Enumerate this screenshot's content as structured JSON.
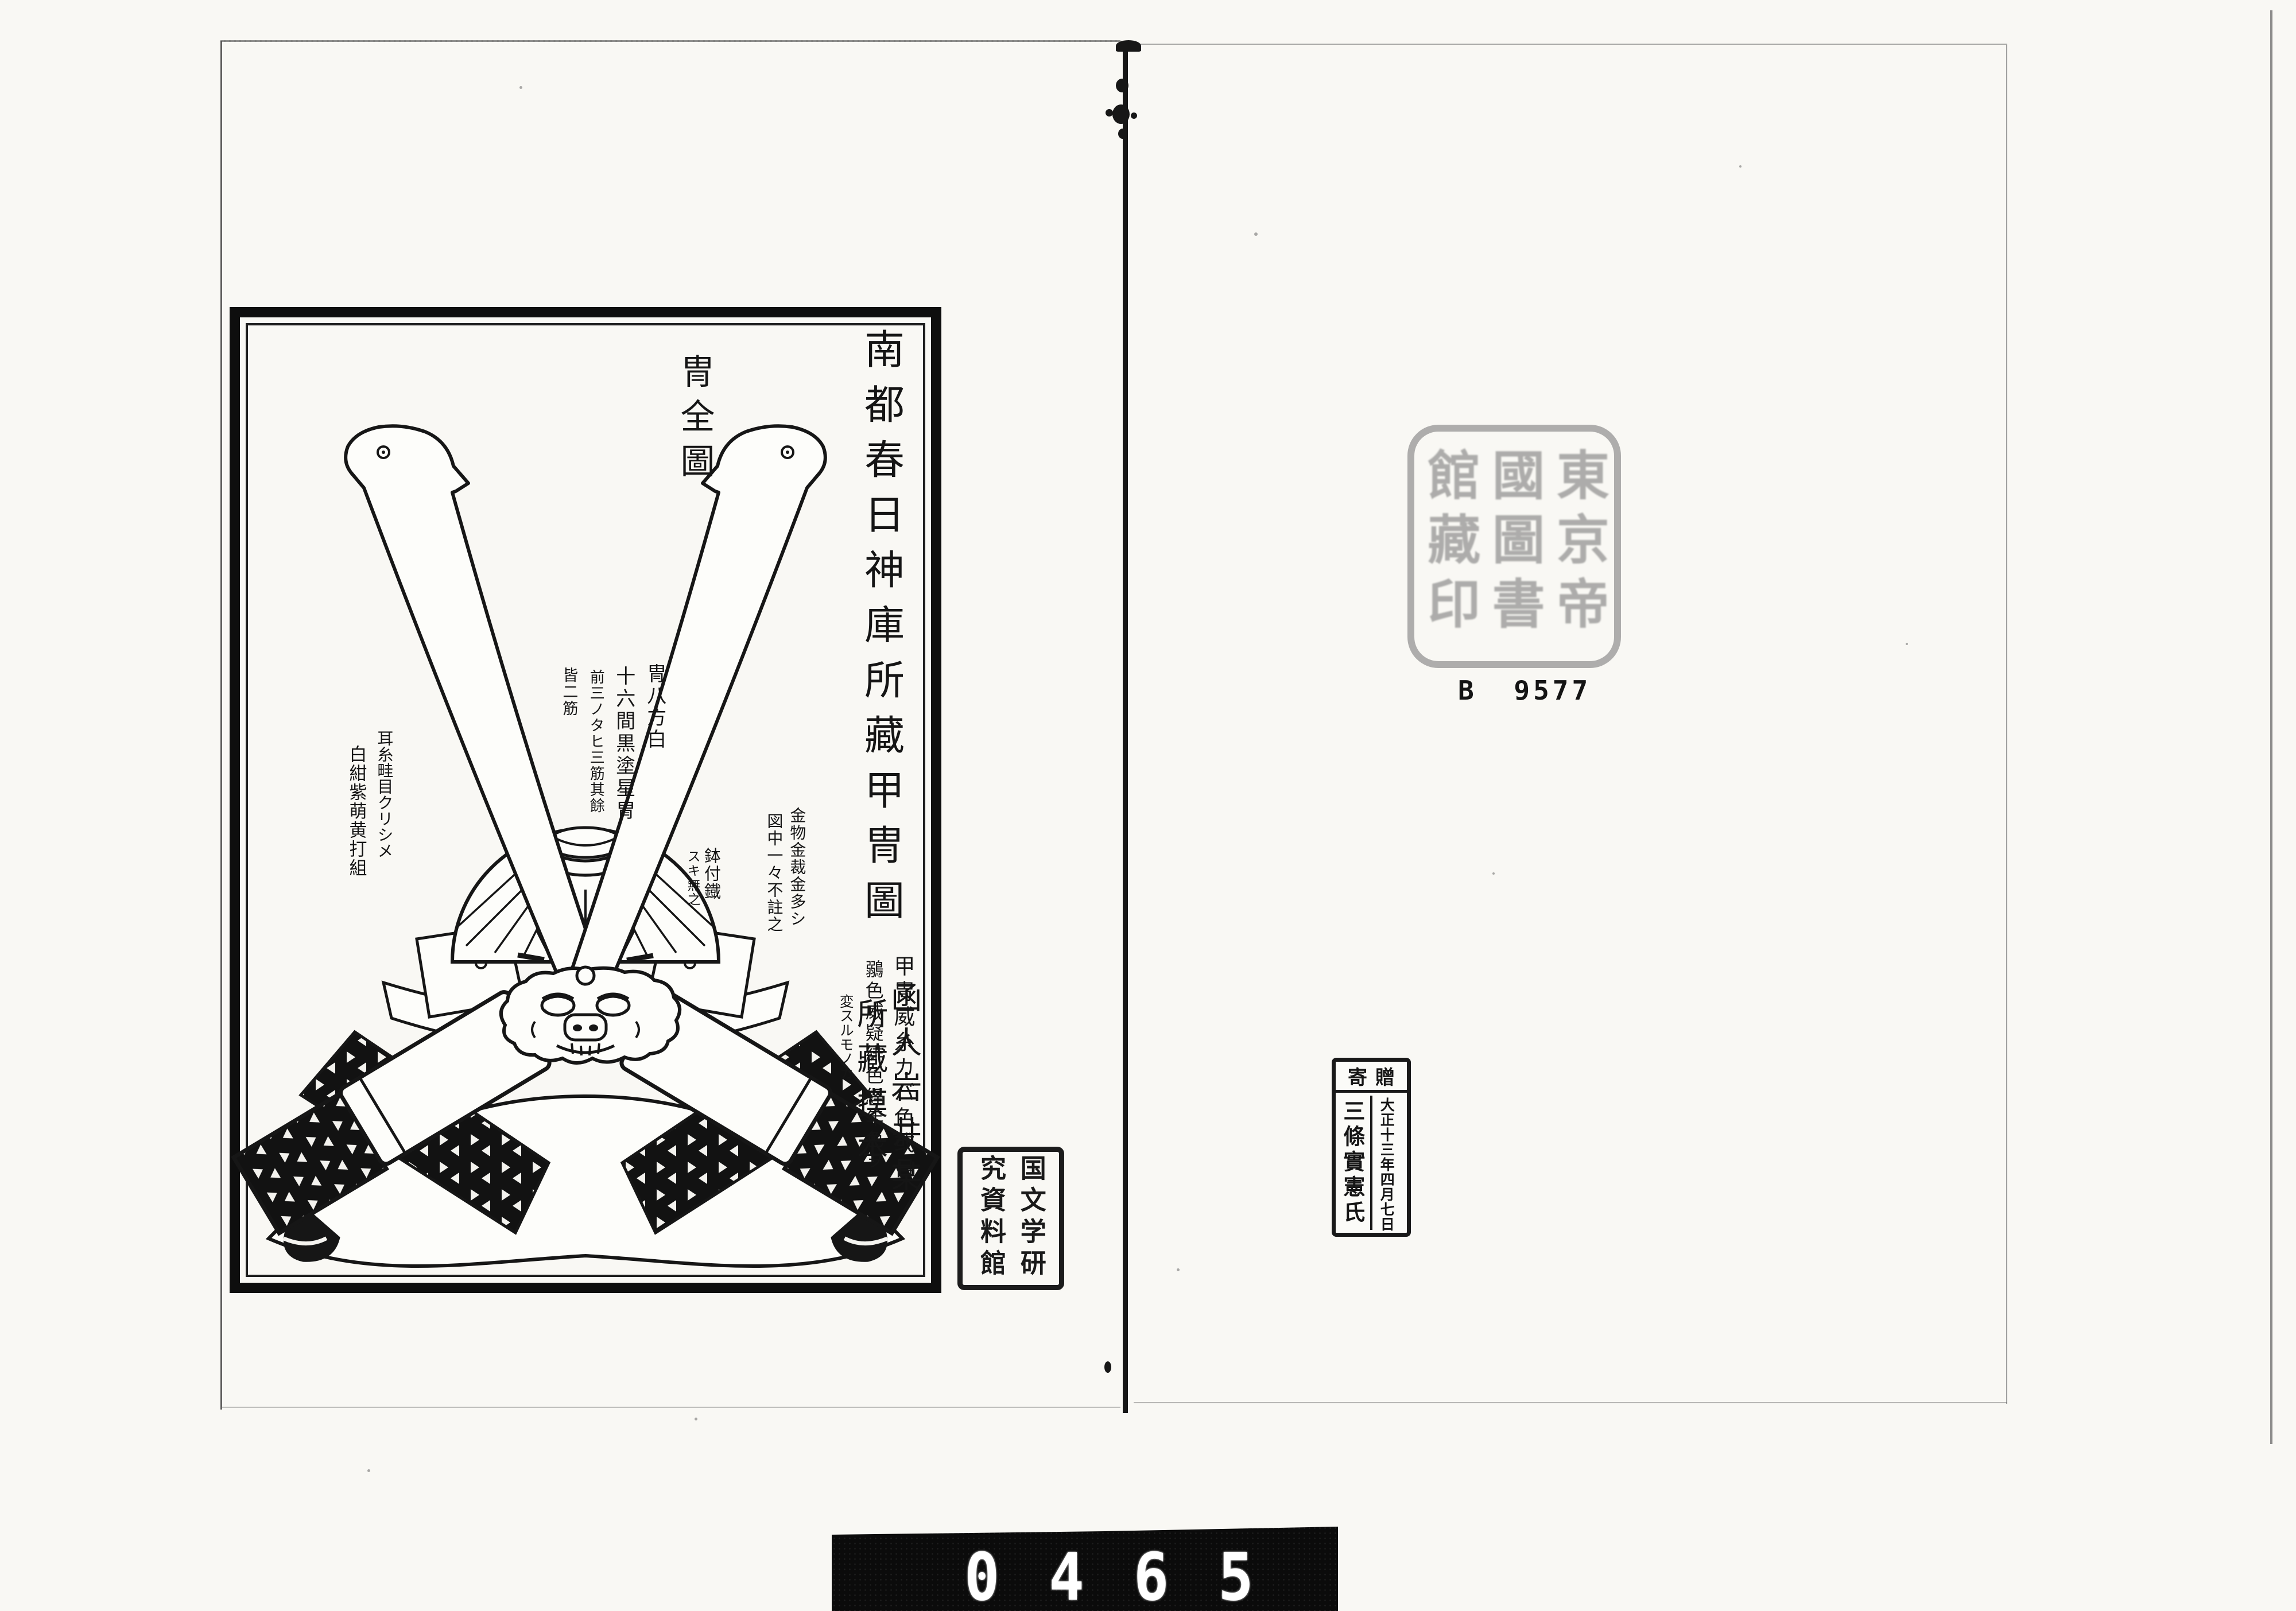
{
  "page": {
    "description": "Scanned spread of a Japanese woodblock-printed book plate",
    "paper_color": "#f9f8f4",
    "ink_color": "#161616"
  },
  "plate": {
    "title": "南都春日神庫所藏甲冑圖",
    "subtitle_right": "函人岩井某",
    "subtitle_left": "所藏摸本",
    "figure_label": "冑全圖",
    "annotations": {
      "hachi_color": "冑八方白",
      "hachi_plates": "十六間黒塗星冑",
      "hachi_ridges": "前三ノタヒ三筋其餘",
      "hachi_ridges_2": "皆二筋",
      "ear_cords": "耳糸畦目クリシメ",
      "ear_cords_2": "白紺紫萌黄打組",
      "bowl_rivets": "鉢付鐡",
      "bowl_rivets_2": "スキ無之",
      "fittings": "金物金裁金多シ",
      "fittings_2": "図中一々不註之",
      "lacing": "甲冑威糸カバ色或日",
      "lacing_2": "鶸色威疑緋色経年色ヲ",
      "lacing_3": "変スルモノカ"
    },
    "illustration": "Front view of a kabuto helmet with two tall bird-headed kuwagata horns, ribbed bowl with hanging three-pronged ornament, demon-face ornament, and wide patterned shikoro wings"
  },
  "stamps": {
    "library_seal": {
      "glyphs": "東京帝國圖書館藏印",
      "note": "very faint square seal-script stamp, largely illegible",
      "color": "#8a8a8a"
    },
    "institution_seal": {
      "text": "国文学研究資料館",
      "note": "black rectangular seal-script stamp"
    },
    "donation_stamp": {
      "header_display": "寄贈",
      "header_reading": "寄贈 (read right-to-left)",
      "date_column": "大正十三年四月七日",
      "name_column": "三條實憲氏"
    }
  },
  "call_number": "B 9577",
  "frame_counter": {
    "digits": "0465",
    "background": "#0b0b0b",
    "digit_color": "#ffffff"
  }
}
